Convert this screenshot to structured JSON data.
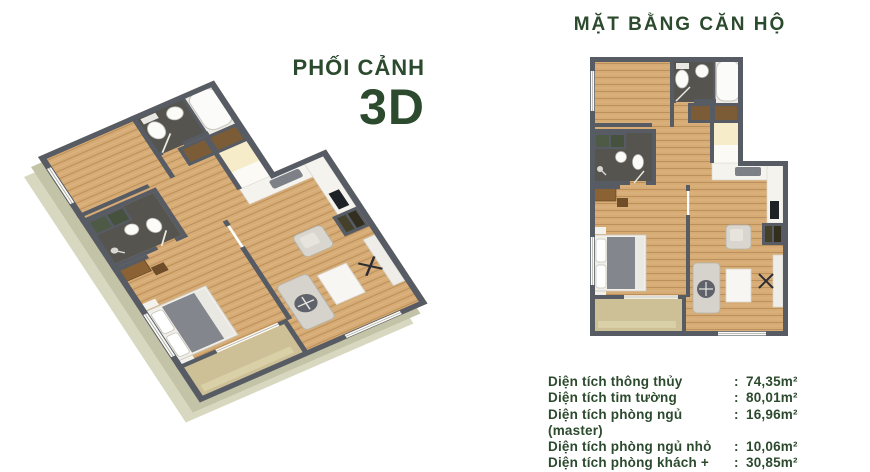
{
  "left_panel": {
    "title_line1": "PHỐI CẢNH",
    "title_line2": "3D"
  },
  "right_panel": {
    "title": "MẶT BẰNG CĂN HỘ",
    "measurements": [
      {
        "label": "Diện tích thông thủy",
        "sep": ":",
        "value": "74,35m²"
      },
      {
        "label": "Diện tích tim tường",
        "sep": ":",
        "value": "80,01m²"
      },
      {
        "label": "Diện tích phòng ngủ (master)",
        "sep": ":",
        "value": "16,96m²"
      },
      {
        "label": "Diện tích phòng ngủ nhỏ",
        "sep": ":",
        "value": "10,06m²"
      },
      {
        "label": "Diện tích phòng khách + bếp",
        "sep": ":",
        "value": "30,85m²"
      }
    ]
  },
  "colors": {
    "accent_green": "#2c4a2e",
    "wall": "#565b64",
    "wood_floor": "#d7ab74",
    "dark_tile": "#56544e",
    "balcony": "#cdc096",
    "balcony_step": "#d9d0a8",
    "cream_closet": "#f6ecc9",
    "white_fixture": "#fbfbf9",
    "shell_light": "#d8d8c1",
    "shell_shade": "#c3c3a7",
    "bed_blanket": "#83868d",
    "sofa": "#d5d3cb",
    "counter_white": "#f4f3ee",
    "cabinet_brown": "#7b5c36"
  }
}
